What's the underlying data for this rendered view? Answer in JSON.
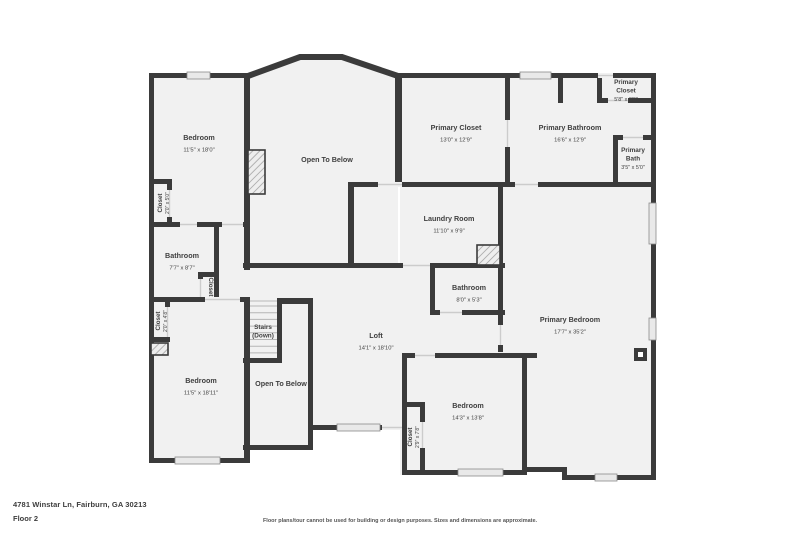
{
  "address": "4781 Winstar Ln, Fairburn, GA 30213",
  "floor_label": "Floor 2",
  "disclaimer": "Floor plans/tour cannot be used for building or design purposes. Sizes and dimensions are approximate.",
  "colors": {
    "wall": "#3b3b3b",
    "room_fill": "#f1f1f1",
    "window_fill": "#e9e9e9",
    "window_frame": "#8a8a8a",
    "opening_line": "#cccccc",
    "tread_line": "#b5b5b5",
    "label_text": "#3f3f3f"
  },
  "rooms": [
    {
      "name": "Bedroom",
      "dims": "11'5\" x 18'0\"",
      "x": 199,
      "y": 140,
      "rot": 0
    },
    {
      "name": "Closet",
      "dims": "2'0\" x 5'0\"",
      "x": 162,
      "y": 203,
      "rot": -90
    },
    {
      "name": "Bathroom",
      "dims": "7'7\" x 8'7\"",
      "x": 182,
      "y": 258,
      "rot": 0
    },
    {
      "name": "Closet",
      "dims": "",
      "x": 209,
      "y": 287,
      "rot": 90
    },
    {
      "name": "Closet",
      "dims": "2'0\" x 4'8\"",
      "x": 160,
      "y": 321,
      "rot": -90
    },
    {
      "name": "Bedroom",
      "dims": "11'5\" x 18'11\"",
      "x": 201,
      "y": 383,
      "rot": 0
    },
    {
      "name": "Stairs\n(Down)",
      "dims": "",
      "x": 263,
      "y": 329,
      "rot": 0
    },
    {
      "name": "Open To Below",
      "dims": "",
      "x": 281,
      "y": 386,
      "rot": 0
    },
    {
      "name": "Open To Below",
      "dims": "",
      "x": 327,
      "y": 162,
      "rot": 0
    },
    {
      "name": "Loft",
      "dims": "14'1\" x 18'10\"",
      "x": 376,
      "y": 338,
      "rot": 0
    },
    {
      "name": "Laundry Room",
      "dims": "11'10\" x 9'9\"",
      "x": 449,
      "y": 221,
      "rot": 0
    },
    {
      "name": "Bathroom",
      "dims": "8'0\" x 5'3\"",
      "x": 469,
      "y": 290,
      "rot": 0
    },
    {
      "name": "Primary Closet",
      "dims": "13'0\" x 12'9\"",
      "x": 456,
      "y": 130,
      "rot": 0
    },
    {
      "name": "Primary Bathroom",
      "dims": "16'6\" x 12'9\"",
      "x": 570,
      "y": 130,
      "rot": 0
    },
    {
      "name": "Primary\nCloset",
      "dims": "5'8\" x 3'0\"",
      "x": 626,
      "y": 84,
      "rot": 0
    },
    {
      "name": "Primary\nBath",
      "dims": "3'5\" x 5'0\"",
      "x": 633,
      "y": 152,
      "rot": 0
    },
    {
      "name": "Primary Bedroom",
      "dims": "17'7\" x 35'2\"",
      "x": 570,
      "y": 322,
      "rot": 0
    },
    {
      "name": "Bedroom",
      "dims": "14'3\" x 13'8\"",
      "x": 468,
      "y": 408,
      "rot": 0
    },
    {
      "name": "Closet",
      "dims": "2'9\" x 7'8\"",
      "x": 412,
      "y": 437,
      "rot": -90
    }
  ]
}
